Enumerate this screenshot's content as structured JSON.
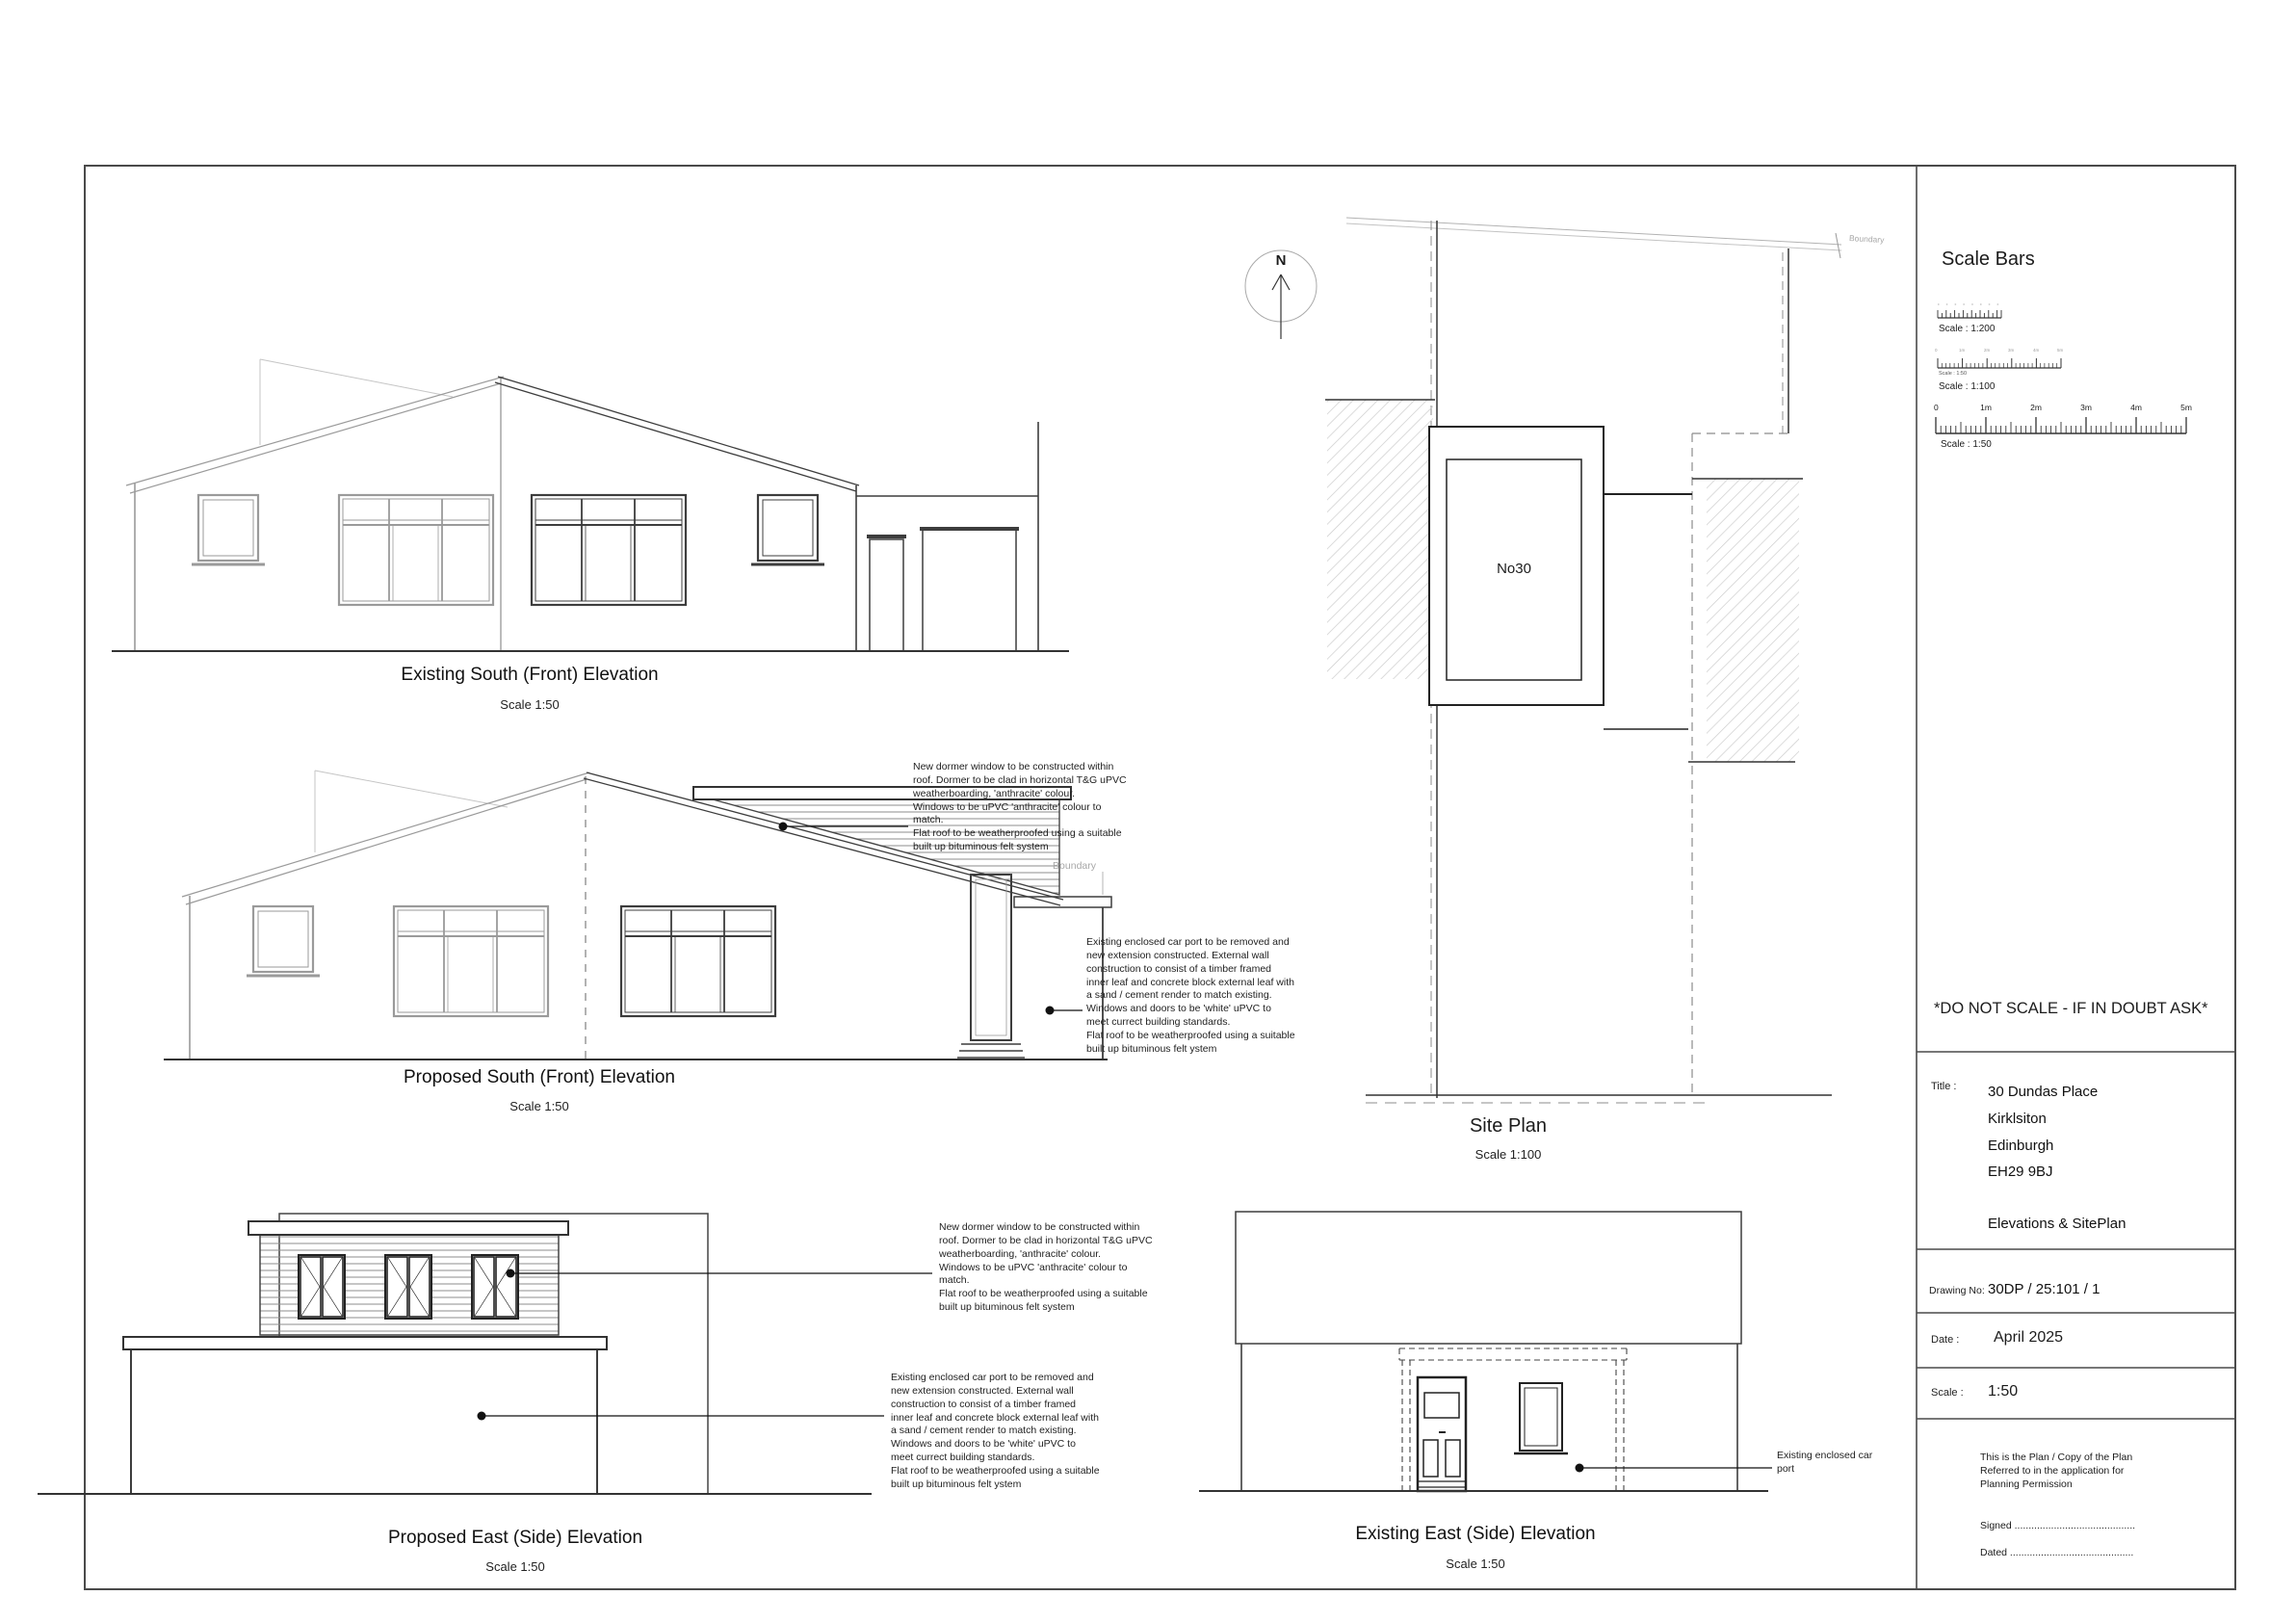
{
  "sheet": {
    "scale_bars": {
      "heading": "Scale Bars",
      "bar200_label": "Scale : 1:200",
      "bar100_label": "Scale : 1:100",
      "bar100_sub": "Scale : 1:50",
      "bar50_label": "Scale : 1:50",
      "ticks": [
        "0",
        "1m",
        "2m",
        "3m",
        "4m",
        "5m"
      ]
    },
    "warning": "*DO NOT SCALE - IF IN DOUBT ASK*",
    "title_block": {
      "title_label": "Title :",
      "address": "30 Dundas Place\nKirklsiton\nEdinburgh\nEH29 9BJ",
      "drawing_title": "Elevations & SitePlan",
      "drawing_no_label": "Drawing No:",
      "drawing_no": "30DP / 25:101 / 1",
      "date_label": "Date :",
      "date": "April 2025",
      "scale_label": "Scale :",
      "scale": "1:50",
      "planning_note": "This is the Plan / Copy of the Plan\nReferred to in the application for\nPlanning Permission",
      "signed": "Signed ...........................................",
      "dated": "Dated ............................................"
    }
  },
  "elevations": {
    "existing_south": {
      "title": "Existing South (Front) Elevation",
      "scale": "Scale 1:50"
    },
    "proposed_south": {
      "title": "Proposed South (Front) Elevation",
      "scale": "Scale 1:50"
    },
    "proposed_east": {
      "title": "Proposed East (Side) Elevation",
      "scale": "Scale 1:50"
    },
    "existing_east": {
      "title": "Existing East (Side) Elevation",
      "scale": "Scale 1:50"
    }
  },
  "site_plan": {
    "title": "Site Plan",
    "scale": "Scale 1:100",
    "house_label": "No30",
    "north_label": "N",
    "boundary_label": "Boundary"
  },
  "annotations": {
    "dormer_note": "New dormer window to be constructed within\nroof. Dormer to be clad in horizontal T&G uPVC\nweatherboarding, 'anthracite' colour.\nWindows to be uPVC 'anthracite' colour to\nmatch.\nFlat roof to be weatherproofed using a suitable\nbuilt up bituminous felt system",
    "extension_note": "Existing enclosed car port to be removed and\nnew extension constructed. External wall\nconstruction to consist of a timber framed\ninner leaf and concrete block external leaf with\na sand / cement render to match existing.\nWindows and doors to be 'white' uPVC to\nmeet currect building standards.\nFlat roof to be weatherproofed using a suitable\nbuilt up bituminous felt ystem",
    "car_port_label": "Existing enclosed car\nport"
  }
}
